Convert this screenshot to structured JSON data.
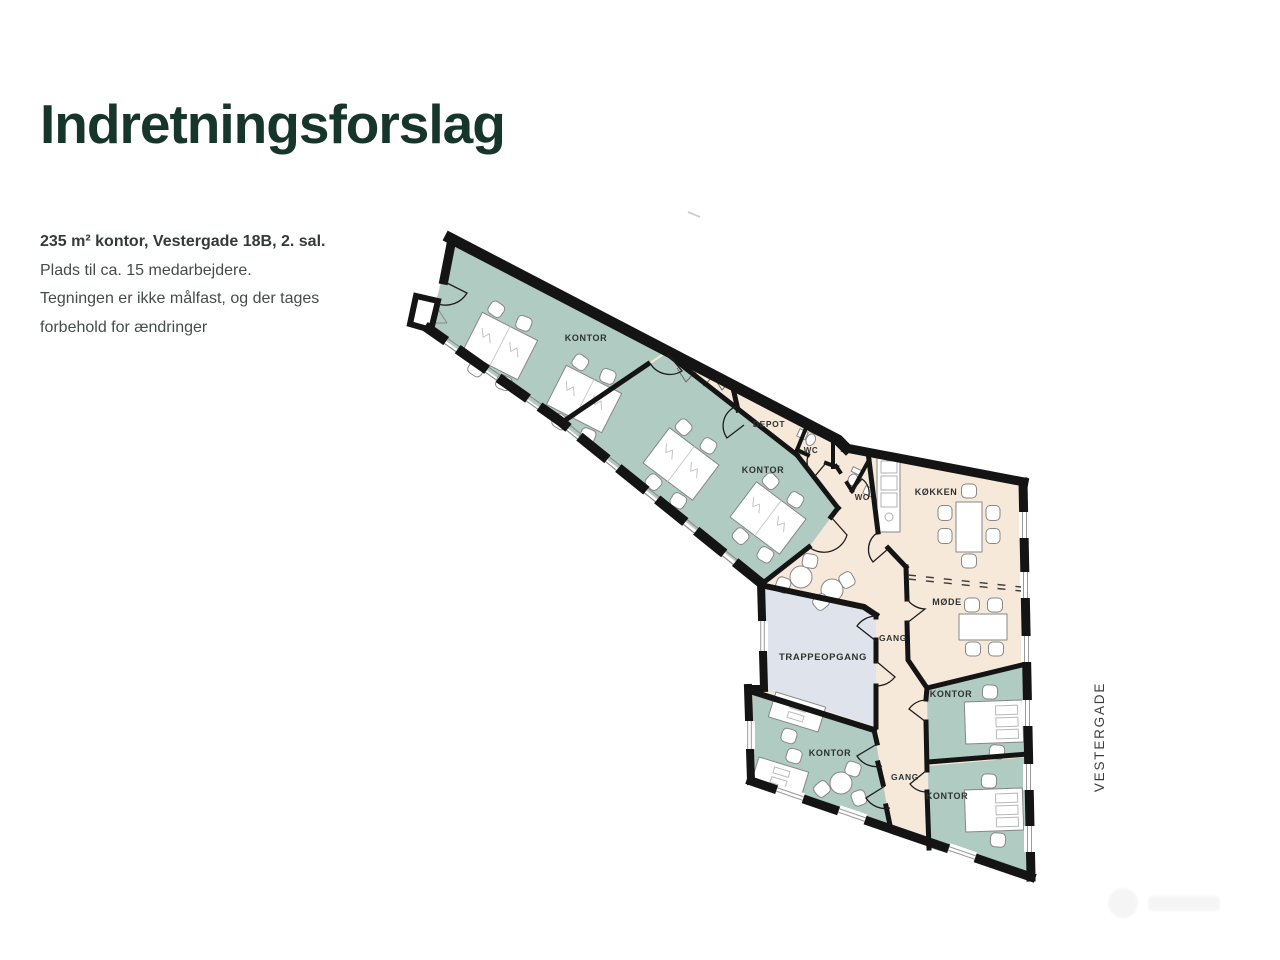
{
  "slide": {
    "title": "Indretningsforslag",
    "description_lines": [
      "235 m² kontor, Vestergade 18B, 2. sal.",
      "Plads til ca. 15 medarbejdere.",
      "Tegningen er ikke målfast, og der tages",
      "forbehold for ændringer"
    ]
  },
  "floorplan": {
    "street_label": "VESTERGADE",
    "room_labels": {
      "kontor_1": "KONTOR",
      "kontor_2": "KONTOR",
      "depot": "DEPOT",
      "wc_1": "WC",
      "wc_2": "WC",
      "koekken": "KØKKEN",
      "moede": "MØDE",
      "gang_upper": "GANG",
      "gang_lower": "GANG",
      "trappeopgang": "TRAPPEOPGANG",
      "kontor_bottom_left": "KONTOR",
      "kontor_right_top": "KONTOR",
      "kontor_right_bottom": "KONTOR"
    },
    "legend_colors": {
      "office_room_fill": "#b0cbc1",
      "common_area_fill": "#f7e9da",
      "stairwell_fill": "#dfe4ec",
      "wall_color": "#141414"
    }
  }
}
